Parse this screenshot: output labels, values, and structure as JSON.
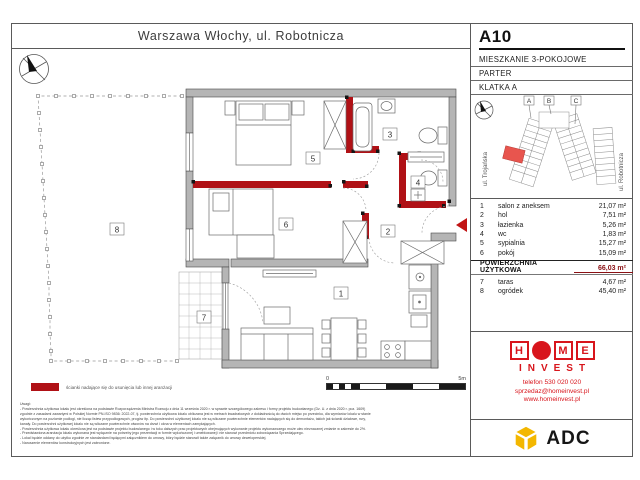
{
  "title": "Warszawa Włochy, ul. Robotnicza",
  "unit": {
    "code": "A10",
    "type": "MIESZKANIE 3-POKOJOWE",
    "floor": "PARTER",
    "staircase": "KLATKA A"
  },
  "site_map": {
    "building_labels": [
      "A",
      "B",
      "C"
    ],
    "street_left": "ul. Trojańska",
    "street_right": "ul. Robotnicza",
    "highlight_color": "#e8554e"
  },
  "rooms": [
    {
      "no": "1",
      "name": "salon z aneksem",
      "area": "21,07 m²"
    },
    {
      "no": "2",
      "name": "hol",
      "area": "7,51 m²"
    },
    {
      "no": "3",
      "name": "łazienka",
      "area": "5,26 m²"
    },
    {
      "no": "4",
      "name": "wc",
      "area": "1,83 m²"
    },
    {
      "no": "5",
      "name": "sypialnia",
      "area": "15,27 m²"
    },
    {
      "no": "6",
      "name": "pokój",
      "area": "15,09 m²"
    }
  ],
  "total": {
    "label": "POWIERZCHNIA UŻYTKOWA",
    "area": "66,03 m²"
  },
  "outdoor": [
    {
      "no": "7",
      "name": "taras",
      "area": "4,67 m²"
    },
    {
      "no": "8",
      "name": "ogródek",
      "area": "45,40 m²"
    }
  ],
  "legend": {
    "swatch_label": "ścianki nadające się do usunięcia lub innej aranżacji",
    "swatch_color": "#b01116"
  },
  "scalebar": {
    "zero": "0",
    "five": "5m"
  },
  "contact": {
    "brand_letters": [
      "H",
      "O",
      "M",
      "E"
    ],
    "brand_sub": "INVEST",
    "phone": "telefon 530 020 020",
    "email": "sprzedaz@homeinvest.pl",
    "website": "www.homeinvest.pl",
    "brand_color": "#d8151c"
  },
  "footer_logo": {
    "label": "ADC",
    "icon_color": "#f3b700"
  },
  "notes": {
    "heading": "Uwagi:",
    "lines": [
      "- Powierzchnia użytkowa lokalu jest określona na podstawie Rozporządzenia Ministra Rozwoju z dnia 11 września 2020 r. w sprawie szczegółowego zakresu i formy projektu budowlanego (Dz. U. z dnia 2020 r. poz. 1609)",
      "zgodnie z zasadami zawartymi w Polskiej Normie PN-ISO 9836: 2022-07, tj. powierzchnia użytkowa lokalu obliczana jest w metrach kwadratowych z dokładnością do dwóch miejsc po przecinku, dla wymiarów lokalu w stanie",
      "wykończonym na poziomie podłogi, nie licząc listew przypodłogowych, progów itp. Do powierzchni użytkowej lokalu nie są wliczane powierzchnie elementów nadających się do demontażu, takich jak ścianki działowe, rury,",
      "kanały. Do powierzchni użytkowej lokalu nie są wliczane powierzchnie otworów na drzwi i okna w elementach zamykających.",
      "- Powierzchnia użytkowa lokalu określona jest na podstawie projektu budowlanego i w toku dalszych prac projektowych obejmujących wykonanie projektu wykonawczego może ulec nieznacznej zmianie w zakresie do 2%.",
      "- Przedstawiona aranżacja lokalu wykonana jest wyłącznie na potrzeby jego prezentacji w formie wykończonej i umeblowanej i nie stanowi przedmiotu zobowiązania Sprzedającego.",
      "- Lokal będzie oddany do użytku zgodnie ze standardami będącymi załącznikiem do umowy, który będzie stanowił także załącznik do umowy deweloperskiej.",
      "- Naruszenie elementów konstrukcyjnych jest zabronione."
    ]
  }
}
